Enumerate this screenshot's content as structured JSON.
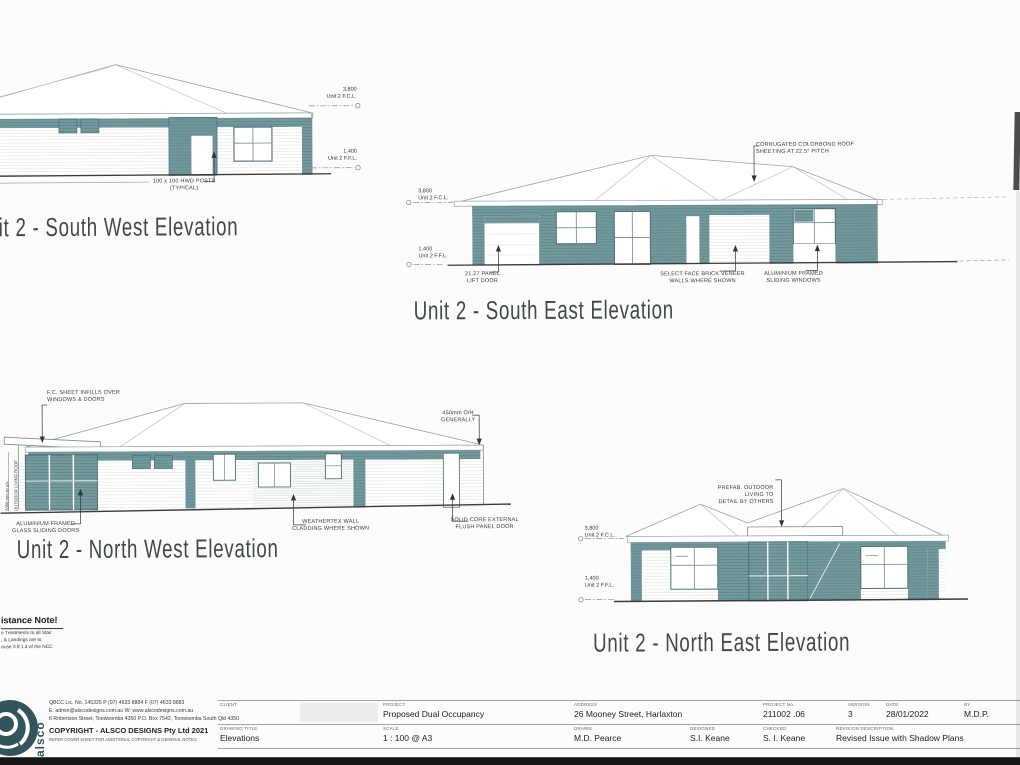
{
  "colors": {
    "teal": "#74999d",
    "teal_dark": "#5d878c",
    "outline": "#93a5a6",
    "ground": "#3a3a3a",
    "ink": "#2e3a3c",
    "logo": "#33545c"
  },
  "elevations": {
    "sw": {
      "title": "Unit 2 - South West Elevation",
      "fcl": "3,800\nUnit 2 F.C.L.",
      "ffl": "1,400\nUnit 2 F.F.L.",
      "note_posts": "100 x 100 HWD POSTS\n(TYPICAL)"
    },
    "se": {
      "title": "Unit 2 - South East Elevation",
      "fcl": "3,800\nUnit 2 F.C.L.",
      "ffl": "1,400\nUnit 2 F.F.L.",
      "note_roof": "CORRUGATED COLORBOND ROOF\nSHEETING AT 22.5° PITCH",
      "note_door": "21.27 PANEL\nLIFT DOOR",
      "note_brick": "SELECT FACE BRICK VENEER\nWALLS WHERE SHOWN",
      "note_windows": "ALUMINIUM FRAMED\nSLIDING WINDOWS"
    },
    "nw": {
      "title": "Unit 2 - North West Elevation",
      "note_infills": "F.C. SHEET INFILLS OVER\nWINDOWS & DOORS",
      "note_overhang": "450mm O/H\nGENERALLY",
      "note_sliding": "ALUMINIUM FRAMED\nGLASS SLIDING DOORS",
      "note_cladding": "WEATHERTEX WALL\nCLADDING WHERE SHOWN",
      "note_door": "SOLID CORE EXTERNAL\nFLUSH PANEL DOOR",
      "dim_height": "2060 mm to u/s",
      "dim_label": "OUTDOOR LIVING ROOF"
    },
    "ne": {
      "title": "Unit 2 - North East Elevation",
      "fcl": "3,800\nUnit 2 F.C.L.",
      "ffl": "1,400\nUnit 2 F.F.L.",
      "note_prefab": "PREFAB. OUTDOOR LIVING TO\nDETAIL BY OTHERS"
    }
  },
  "slip_note": {
    "heading": "istance Note!",
    "line1": "e Treatments to all Stair",
    "line2": ", & Landings are to",
    "line3": "ause 3.9.1.4 of the NCC"
  },
  "logo": {
    "brand": "alsco",
    "contact1": "QBCC Lic. No. 145325    P (07) 4633 8884    F (07) 4633 8883",
    "contact2": "E: admin@alscodesigns.com.au    W: www.alscodesigns.com.au",
    "contact3": "6 Robertson Street, Toowoomba 4350    P.O. Box 7542, Toowoomba South Qld 4350",
    "copyright": "COPYRIGHT  -  ALSCO DESIGNS Pty Ltd 2021",
    "copyright_note": "REFER COVER SHEET FOR ADDITIONAL COPYRIGHT & GENERAL NOTES"
  },
  "title_block": {
    "row1": [
      {
        "label": "CLIENT",
        "value": ""
      },
      {
        "label": "PROJECT",
        "value": "Proposed Dual Occupancy"
      },
      {
        "label": "ADDRESS",
        "value": "26 Mooney Street, Harlaxton"
      },
      {
        "label": "PROJECT No.",
        "value": "211002 .06"
      },
      {
        "label": "VERSION",
        "value": "3"
      },
      {
        "label": "DATE",
        "value": "28/01/2022"
      },
      {
        "label": "BY",
        "value": "M.D.P."
      }
    ],
    "row2": [
      {
        "label": "DRAWING TITLE",
        "value": "Elevations"
      },
      {
        "label": "SCALE",
        "value": "1 : 100 @ A3"
      },
      {
        "label": "DRAWN",
        "value": "M.D. Pearce"
      },
      {
        "label": "DESIGNED",
        "value": "S.I. Keane"
      },
      {
        "label": "CHECKED",
        "value": "S. I. Keane"
      },
      {
        "label": "REVISION DESCRIPTION",
        "value": "Revised Issue with Shadow Plans"
      }
    ]
  }
}
